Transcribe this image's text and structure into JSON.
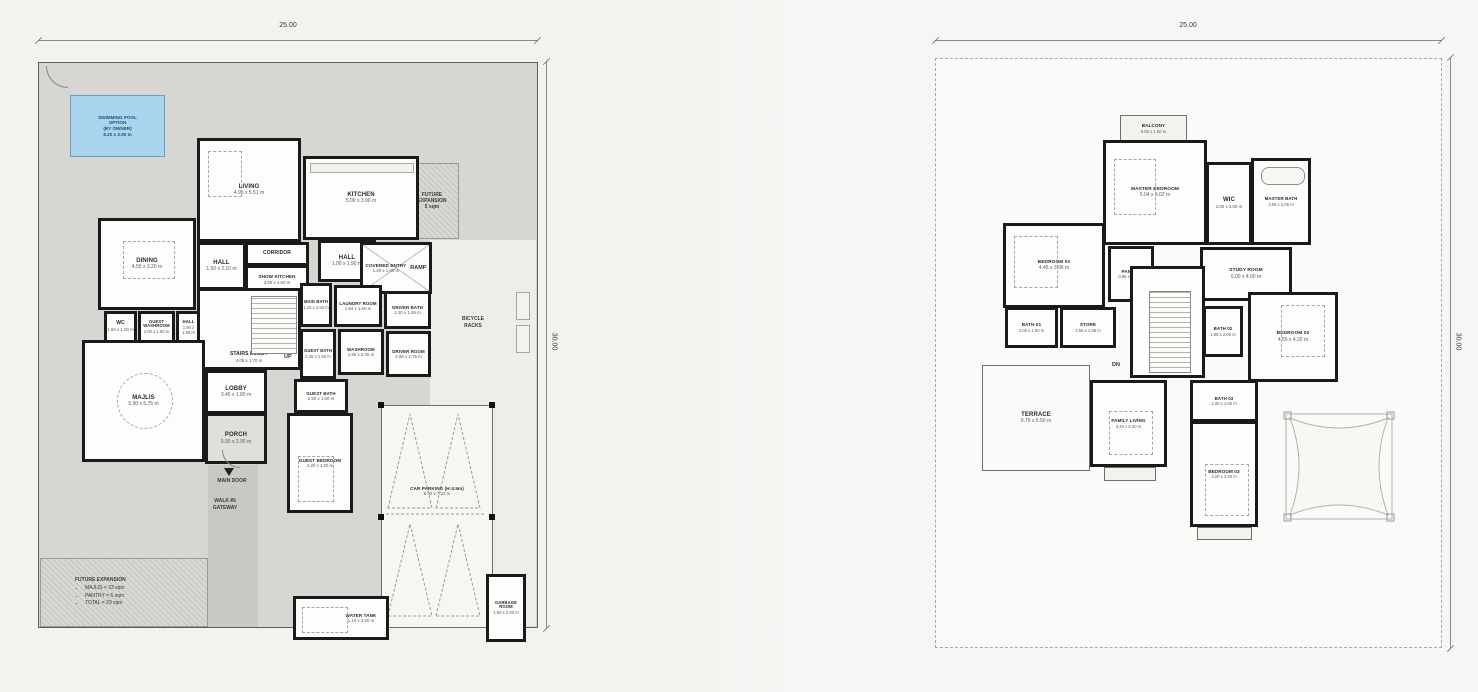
{
  "colors": {
    "paper": "#f5f4f1",
    "wall": "#1a1a1a",
    "yard": "#d7d6d3",
    "yard_light": "#eeedea",
    "walkway": "#c9c8c5",
    "room_fill": "#fdfdfb",
    "pool_fill": "#a9d6ee",
    "pool_border": "#64a0c4",
    "open_fill": "#e0dfdc"
  },
  "plans": {
    "ground": {
      "dim_top": "25.00",
      "dim_right": "30.00",
      "pool": {
        "l1": "SWIMMING POOL",
        "l2": "OPTION",
        "l3": "(BY OWNER)",
        "l4": "8.20 x 3.90 m"
      },
      "rooms": {
        "living": {
          "name": "LIVING",
          "dims": "4.95 x 5.51 m"
        },
        "kitchen": {
          "name": "KITCHEN",
          "dims": "5.00 x 3.90 m"
        },
        "dining": {
          "name": "DINING",
          "dims": "4.55 x 3.20 m"
        },
        "hall_left": {
          "name": "HALL",
          "dims": "1.50 x 2.10 m"
        },
        "corridor": {
          "name": "CORRIDOR",
          "dims": "3.00 x 1.00 m"
        },
        "show_kitchen": {
          "name": "SHOW KITCHEN",
          "dims": "3.50 x 4.60 m"
        },
        "hall_right": {
          "name": "HALL",
          "dims": "1.00 x 1.90 m"
        },
        "covered_entry": {
          "name": "COVERED ENTRY",
          "dims": "1.40 x 1.90 m"
        },
        "wc": {
          "name": "WC",
          "dims": "1.50 x 1.00 m"
        },
        "guest_washroom": {
          "name": "GUEST WASHROOM",
          "dims": "2.00 x 1.60 m"
        },
        "hall_small": {
          "name": "HALL",
          "dims": "1.90 x 1.90 m"
        },
        "stairs_lobby": {
          "name": "STAIRS LOBBY",
          "dims": "4.05 x 1.70 m"
        },
        "majlis": {
          "name": "MAJLIS",
          "dims": "5.90 x 5.75 m"
        },
        "lobby": {
          "name": "LOBBY",
          "dims": "3.45 x 1.80 m"
        },
        "porch": {
          "name": "PORCH",
          "dims": "5.90 x 2.90 m"
        },
        "maid_bath": {
          "name": "MAID BATH",
          "dims": "1.10 x 2.50 m"
        },
        "laundry": {
          "name": "LAUNDRY ROOM",
          "dims": "1.94 x 1.60 m"
        },
        "driver_bath": {
          "name": "DRIVER BATH",
          "dims": "2.20 x 1.95 m"
        },
        "guest_bath1": {
          "name": "GUEST BATH",
          "dims": "1.48 x 2.50 m"
        },
        "washroom": {
          "name": "WASHROOM",
          "dims": "1.95 x 2.05 m"
        },
        "driver_room": {
          "name": "DRIVER ROOM",
          "dims": "2.65 x 2.75 m"
        },
        "guest_bath2": {
          "name": "GUEST BATH",
          "dims": "2.50 x 1.60 m"
        },
        "guest_bedroom": {
          "name": "GUEST BEDROOM",
          "dims": "4.20 x 4.00 m"
        },
        "car_parking": {
          "name": "CAR PARKING (H:4.5m)",
          "dims": "5.43 x 7.23 m"
        },
        "water_tank": {
          "name": "WATER TANK",
          "dims": "1.10 x 3.00 m"
        },
        "garbage": {
          "name": "GARBAGE ROOM",
          "dims": "1.00 x 2.00 m"
        }
      },
      "labels": {
        "up": "UP",
        "ramp": "RAMP",
        "main_door": "MAIN DOOR",
        "walk_in": {
          "l1": "WALK-IN",
          "l2": "GATEWAY"
        },
        "bicycle": {
          "l1": "BICYCLE",
          "l2": "RACKS"
        },
        "future_area": {
          "l1": "FUTURE",
          "l2": "EXPANSION",
          "l3": "5 sqm"
        },
        "future_list": {
          "title": "FUTURE EXPANSION",
          "i1": "MAJLIS = 23 sqm",
          "i2": "PANTRY = 6 sqm",
          "i3": "TOTAL = 29 sqm"
        }
      }
    },
    "first": {
      "dim_top": "25.00",
      "dim_right": "30.00",
      "rooms": {
        "balcony": {
          "name": "BALCONY",
          "dims": "5.00 x 1.50 m"
        },
        "master_bedroom": {
          "name": "MASTER BEDROOM",
          "dims": "5.04 x 5.02 m"
        },
        "wic": {
          "name": "WIC",
          "dims": "2.00 x 3.00 m"
        },
        "master_bath": {
          "name": "MASTER BATH",
          "dims": "3.95 x 2.05 m"
        },
        "bedroom_01": {
          "name": "BEDROOM 01",
          "dims": "4.45 x 3.95 m"
        },
        "pantry": {
          "name": "PANTRY",
          "dims": "0.95 x 2.75 m"
        },
        "study": {
          "name": "STUDY ROOM",
          "dims": "5.00 x 4.00 m"
        },
        "bath_01": {
          "name": "BATH 01",
          "dims": "2.05 x 1.60 m"
        },
        "store": {
          "name": "STORE",
          "dims": "2.50 x 1.95 m"
        },
        "stairs_hall": {
          "name": "STAIRS HALL",
          "dims": "4.74 x 3.04 m"
        },
        "bath_02": {
          "name": "BATH 02",
          "dims": "1.95 x 2.00 m"
        },
        "bedroom_02": {
          "name": "BEDROOM 02",
          "dims": "4.55 x 4.20 m"
        },
        "family_living": {
          "name": "FAMILY LIVING",
          "dims": "3.40 x 5.30 m"
        },
        "terrace": {
          "name": "TERRACE",
          "dims": "6.75 x 5.50 m"
        },
        "bath_03": {
          "name": "BATH 03",
          "dims": "2.30 x 1.60 m"
        },
        "bedroom_03": {
          "name": "BEDROOM 03",
          "dims": "4.20 x 4.30 m"
        }
      },
      "labels": {
        "dn": "DN"
      }
    }
  }
}
